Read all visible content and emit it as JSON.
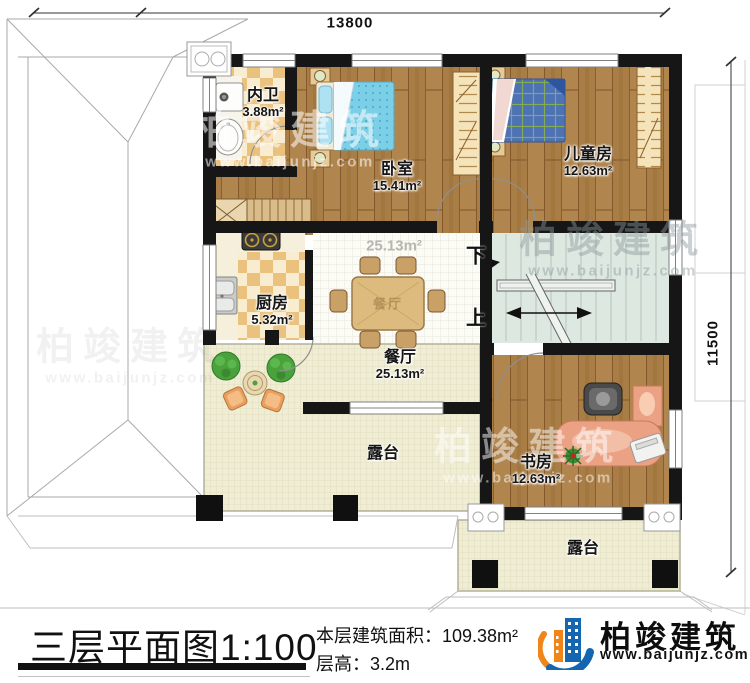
{
  "plan": {
    "dimensions": {
      "width_mm": "13800",
      "height_mm": "11500"
    },
    "rooms": {
      "bathroom": {
        "name": "内卫",
        "area": "3.88m²"
      },
      "bedroom": {
        "name": "卧室",
        "area": "15.41m²"
      },
      "kids_room": {
        "name": "儿童房",
        "area": "12.63m²"
      },
      "kitchen": {
        "name": "厨房",
        "area": "5.32m²"
      },
      "dining": {
        "name": "餐厅",
        "area": "25.13m²"
      },
      "study": {
        "name": "书房",
        "area": "12.63m²"
      },
      "terrace_main": {
        "name": "露台"
      },
      "terrace_front": {
        "name": "露台"
      }
    },
    "stairs": {
      "down_label": "下",
      "up_label": "上"
    },
    "dining_ghost_area": "25.13m²",
    "dining_table_label": "餐厅"
  },
  "footer": {
    "title": "三层平面图",
    "scale": "1:100",
    "floor_area_label": "本层建筑面积：",
    "floor_area_value": "109.38m²",
    "floor_height_label": "层高：",
    "floor_height_value": "3.2m"
  },
  "brand": {
    "name": "柏竣建筑",
    "website": "www.baijunjz.com"
  },
  "watermark": {
    "name": "柏竣建筑",
    "website": "www.baijunjz.com"
  },
  "colors": {
    "wall": "#161616",
    "wood": "#a87c45",
    "brand_blue": "#1566b0",
    "brand_orange": "#f08519"
  }
}
